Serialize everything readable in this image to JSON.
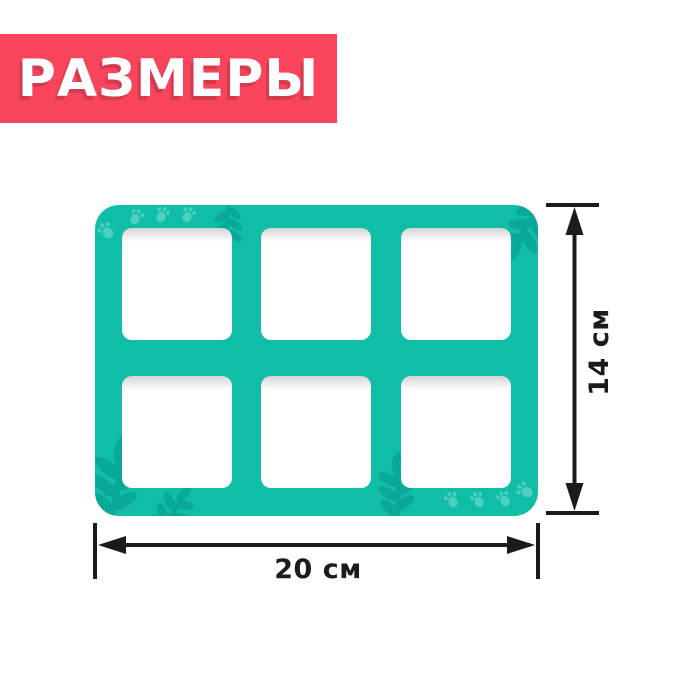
{
  "title_banner": {
    "label": "РАЗМЕРЫ"
  },
  "board": {
    "rows": 2,
    "cols": 3,
    "cavity_count": 6,
    "decorations": {
      "paw_prints": [
        "top-left",
        "bottom-right"
      ],
      "leaf_branches": [
        "top-center",
        "top-right",
        "bottom-left",
        "bottom-center"
      ]
    }
  },
  "dimensions": {
    "height": {
      "label": "14 см",
      "value_cm": 14
    },
    "width": {
      "label": "20 см",
      "value_cm": 20
    }
  },
  "colors": {
    "banner_bg": "#f8455c",
    "board_teal": "#10bea7",
    "decoration_light": "#4ed0be",
    "decoration_dark": "#0aa896",
    "dimension_line": "#1b1b1b",
    "background": "#ffffff"
  }
}
